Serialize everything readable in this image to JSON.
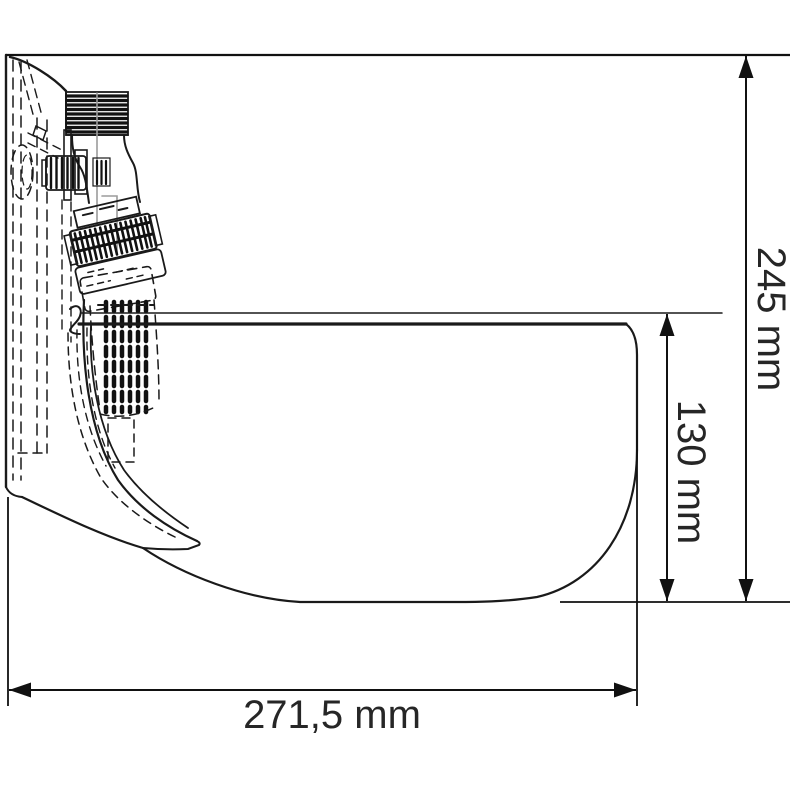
{
  "drawing": {
    "description": "Side-view technical line drawing of a wall-mounted drinking bowl with valve assembly and dimension annotations",
    "background": "#ffffff",
    "line_color": "#1a1a1a",
    "gray_color": "#9b9b9b",
    "dimensions": {
      "total_height": "245 mm",
      "bowl_depth": "130 mm",
      "total_width": "271,5 mm"
    }
  }
}
